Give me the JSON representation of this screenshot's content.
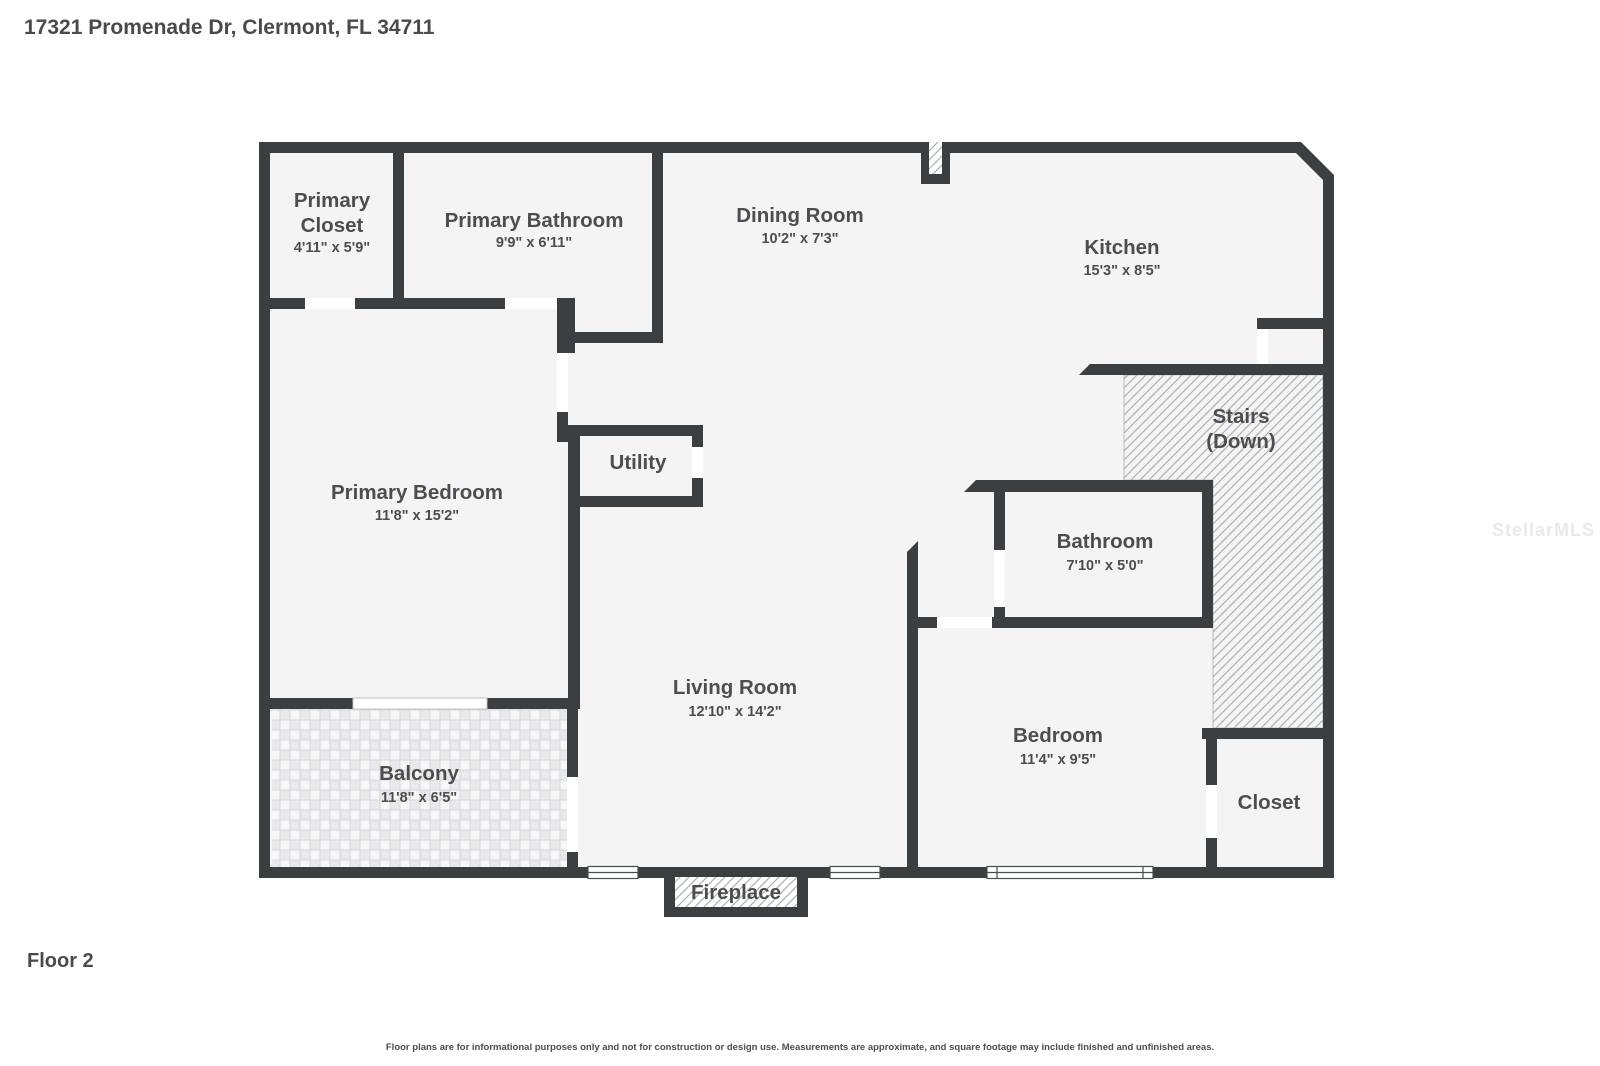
{
  "page": {
    "title": "17321 Promenade Dr, Clermont, FL 34711",
    "floor_label": "Floor 2",
    "disclaimer": "Floor plans are for informational purposes only and not for construction or design use. Measurements are approximate, and square footage may include finished and unfinished areas.",
    "watermark": "StellarMLS"
  },
  "colors": {
    "wall": "#3c3f42",
    "floor": "#f4f4f5",
    "background": "#ffffff",
    "text": "#4b4d50",
    "door_gap": "#ffffff",
    "hatch_line": "#aeb0b3",
    "tile_line": "#d7d7da"
  },
  "rooms": {
    "primary_closet": {
      "line1": "Primary",
      "line2": "Closet",
      "dims": "4'11\" x 5'9\""
    },
    "primary_bathroom": {
      "name": "Primary Bathroom",
      "dims": "9'9\" x 6'11\""
    },
    "dining_room": {
      "name": "Dining Room",
      "dims": "10'2\" x 7'3\""
    },
    "kitchen": {
      "name": "Kitchen",
      "dims": "15'3\" x 8'5\""
    },
    "primary_bedroom": {
      "name": "Primary Bedroom",
      "dims": "11'8\" x 15'2\""
    },
    "utility": {
      "name": "Utility"
    },
    "stairs": {
      "line1": "Stairs",
      "line2": "(Down)"
    },
    "bathroom": {
      "name": "Bathroom",
      "dims": "7'10\" x 5'0\""
    },
    "living_room": {
      "name": "Living Room",
      "dims": "12'10\" x 14'2\""
    },
    "bedroom": {
      "name": "Bedroom",
      "dims": "11'4\" x 9'5\""
    },
    "balcony": {
      "name": "Balcony",
      "dims": "11'8\" x 6'5\""
    },
    "closet": {
      "name": "Closet"
    },
    "fireplace": {
      "name": "Fireplace"
    }
  }
}
